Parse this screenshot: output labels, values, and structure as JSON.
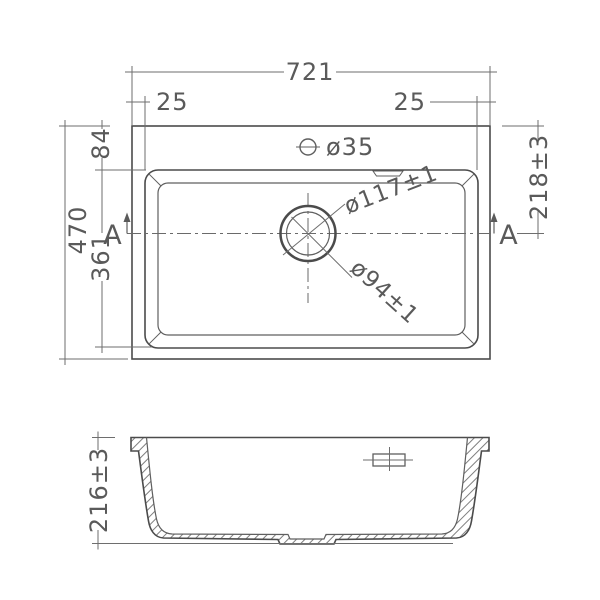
{
  "top_view": {
    "overall_width": "721",
    "corner_offset_left": "25",
    "corner_offset_right": "25",
    "overall_depth": "470",
    "rim_to_bowl": "84",
    "bowl_front_to_back": "361",
    "centerline_from_top": "218±3",
    "tap_hole_diameter": "ø35",
    "drain_outer_diameter": "ø117±1",
    "drain_inner_diameter": "ø94±1",
    "section_label_left": "A",
    "section_label_right": "A"
  },
  "section_view": {
    "bowl_depth": "216±3"
  }
}
